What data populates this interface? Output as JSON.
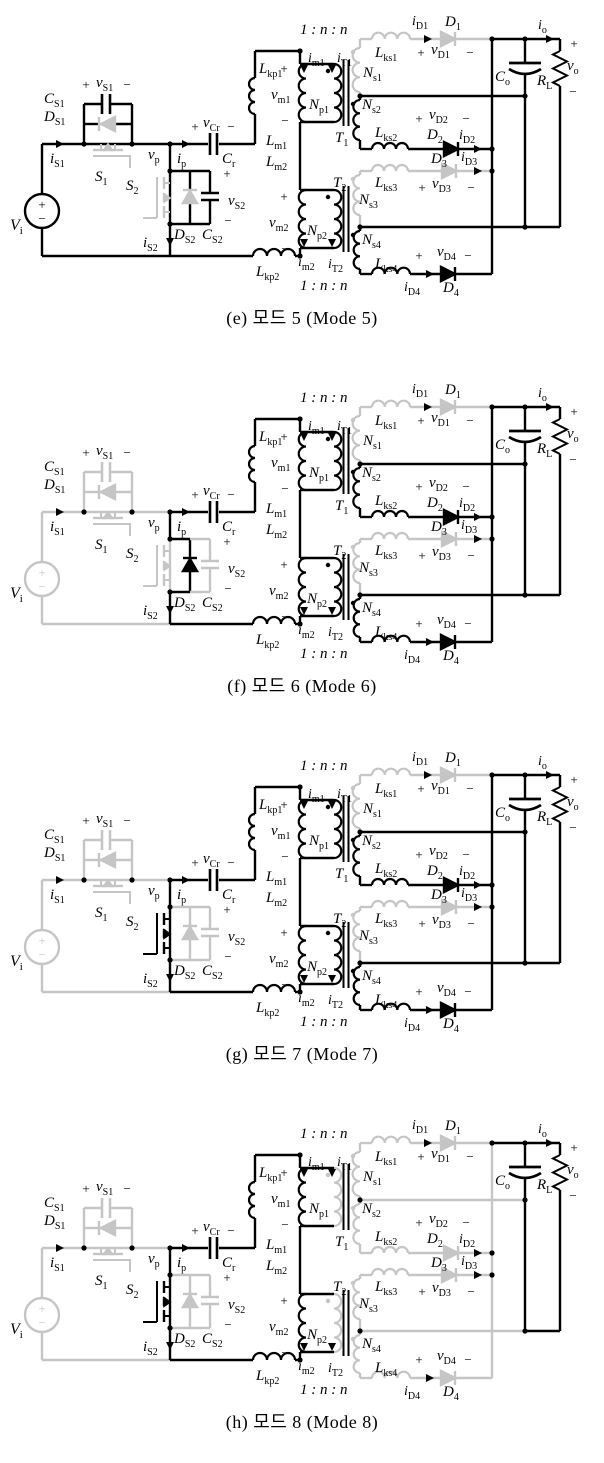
{
  "colors": {
    "active": "#000000",
    "inactive": "#c5c5c5"
  },
  "labels": {
    "vi": [
      "V",
      "i"
    ],
    "is1": [
      "i",
      "S1"
    ],
    "cs1": [
      "C",
      "S1"
    ],
    "ds1": [
      "D",
      "S1"
    ],
    "vs1": [
      "v",
      "S1"
    ],
    "s1": [
      "S",
      "1"
    ],
    "vp": [
      "v",
      "p"
    ],
    "ip": [
      "i",
      "p"
    ],
    "vcr": [
      "v",
      "Cr"
    ],
    "cr": [
      "C",
      "r"
    ],
    "lkp1": [
      "L",
      "kp1"
    ],
    "s2": [
      "S",
      "2"
    ],
    "ds2": [
      "D",
      "S2"
    ],
    "cs2": [
      "C",
      "S2"
    ],
    "vs2": [
      "v",
      "S2"
    ],
    "is2": [
      "i",
      "S2"
    ],
    "lkp2": [
      "L",
      "kp2"
    ],
    "lm1": [
      "L",
      "m1"
    ],
    "lm2": [
      "L",
      "m2"
    ],
    "vm1": [
      "v",
      "m1"
    ],
    "vm2": [
      "v",
      "m2"
    ],
    "im1": [
      "i",
      "m1"
    ],
    "it1": [
      "i",
      "T1"
    ],
    "np1": [
      "N",
      "p1"
    ],
    "t1": [
      "T",
      "1"
    ],
    "im2": [
      "i",
      "m2"
    ],
    "it2": [
      "i",
      "T2"
    ],
    "np2": [
      "N",
      "p2"
    ],
    "t2": [
      "T",
      "2"
    ],
    "ratio": "1 : n : n",
    "ns1": [
      "N",
      "s1"
    ],
    "lks1": [
      "L",
      "ks1"
    ],
    "id1": [
      "i",
      "D1"
    ],
    "d1": [
      "D",
      "1"
    ],
    "vd1": [
      "v",
      "D1"
    ],
    "ns2": [
      "N",
      "s2"
    ],
    "lks2": [
      "L",
      "ks2"
    ],
    "d2": [
      "D",
      "2"
    ],
    "id2": [
      "i",
      "D2"
    ],
    "vd2": [
      "v",
      "D2"
    ],
    "ns3": [
      "N",
      "s3"
    ],
    "lks3": [
      "L",
      "ks3"
    ],
    "d3": [
      "D",
      "3"
    ],
    "id3": [
      "i",
      "D3"
    ],
    "vd3": [
      "v",
      "D3"
    ],
    "ns4": [
      "N",
      "s4"
    ],
    "lks4": [
      "L",
      "ks4"
    ],
    "d4": [
      "D",
      "4"
    ],
    "id4": [
      "i",
      "D4"
    ],
    "vd4": [
      "v",
      "D4"
    ],
    "co": [
      "C",
      "o"
    ],
    "rl": [
      "R",
      "L"
    ],
    "io": [
      "i",
      "o"
    ],
    "vo": [
      "v",
      "o"
    ],
    "plus": "+",
    "minus": "−"
  },
  "figures": [
    {
      "id": "e",
      "caption": "(e) 모드 5 (Mode 5)",
      "inactive_parts": [
        "ds1-sym",
        "s1-mos-sym",
        "ds2-sym",
        "s2-mos-sym",
        "sec1",
        "sec3"
      ]
    },
    {
      "id": "f",
      "caption": "(f) 모드 6 (Mode 6)",
      "inactive_parts": [
        "vi-loop",
        "rail-b-vp",
        "s1-branch",
        "ds1-sym",
        "s1-mos-sym",
        "s2-col",
        "s2-mos-sym",
        "cs2-branch",
        "sec1",
        "sec3"
      ]
    },
    {
      "id": "g",
      "caption": "(g) 모드 7 (Mode 7)",
      "inactive_parts": [
        "vi-loop",
        "rail-b-vp",
        "s1-branch",
        "ds1-sym",
        "s1-mos-sym",
        "ds2-branch",
        "ds2-sym",
        "cs2-branch",
        "jog-inner",
        "sec1",
        "sec3"
      ]
    },
    {
      "id": "h",
      "caption": "(h) 모드 8 (Mode 8)",
      "inactive_parts": [
        "vi-loop",
        "rail-b-vp",
        "s1-branch",
        "ds1-sym",
        "s1-mos-sym",
        "ds2-branch",
        "ds2-sym",
        "cs2-branch",
        "jog-inner",
        "sec1",
        "sec2",
        "sec3",
        "sec4",
        "t1-np",
        "t2-np",
        "ct1-rail",
        "ct2-rail",
        "bus-a"
      ]
    }
  ]
}
